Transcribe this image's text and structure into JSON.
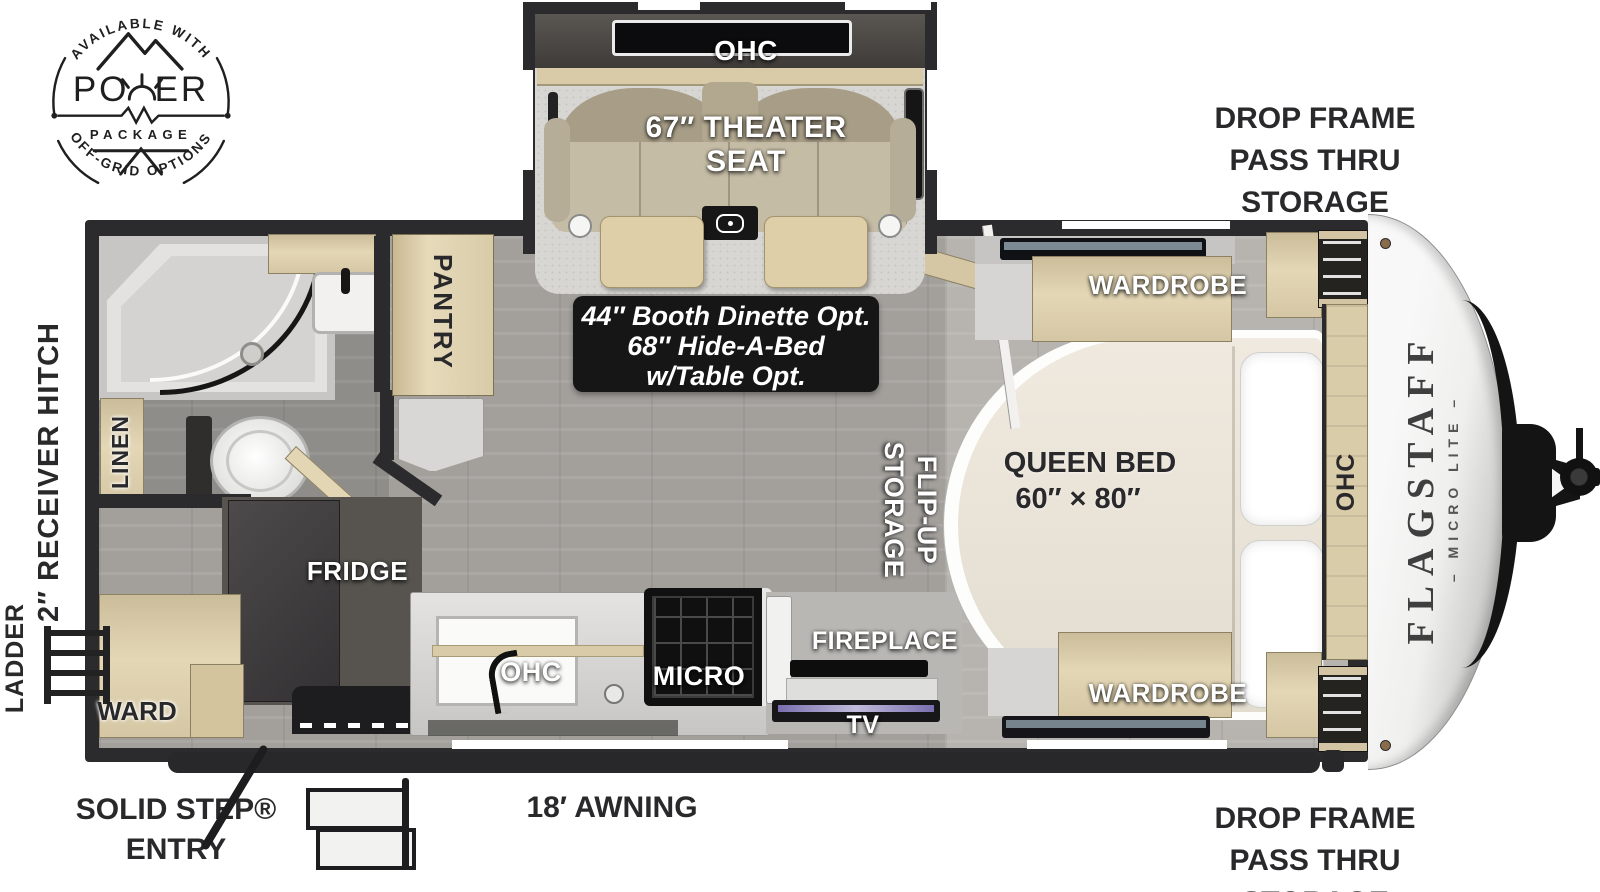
{
  "badge": {
    "arc_top": "AVAILABLE WITH",
    "power_left": "PO",
    "power_right": "ER",
    "package": "PACKAGE",
    "arc_bottom": "OFF-GRID OPTIONS"
  },
  "slide": {
    "ohc": "OHC",
    "seat_line1": "67″ THEATER",
    "seat_line2": "SEAT"
  },
  "storage_top": {
    "l1": "DROP FRAME",
    "l2": "PASS THRU",
    "l3": "STORAGE"
  },
  "storage_bottom": {
    "l1": "DROP FRAME",
    "l2": "PASS THRU",
    "l3": "STORAGE"
  },
  "bedroom": {
    "wardrobe_top": "WARDROBE",
    "wardrobe_bottom": "WARDROBE",
    "queen_line1": "QUEEN BED",
    "queen_line2": "60″ × 80″",
    "ohc": "OHC",
    "flip_line1": "FLIP-UP",
    "flip_line2": "STORAGE"
  },
  "brand": {
    "name": "FLAGSTAFF",
    "sub": "– MICRO LITE –"
  },
  "galley": {
    "pantry": "PANTRY",
    "fridge": "FRIDGE",
    "linen": "LINEN",
    "ward": "WARD",
    "ohc": "OHC",
    "micro": "MICRO",
    "fireplace": "FIREPLACE",
    "tv": "TV"
  },
  "option_box": {
    "l1": "44″ Booth Dinette Opt.",
    "l2": "68″ Hide-A-Bed",
    "l3": "w/Table Opt."
  },
  "exterior": {
    "receiver_hitch": "2″ RECEIVER HITCH",
    "ladder": "LADDER",
    "entry_line1": "SOLID STEP®",
    "entry_line2": "ENTRY",
    "awning": "18′ AWNING"
  },
  "colors": {
    "wall": "#2b2a2c",
    "wood": "#ddcfae",
    "floor": "#a3a09c",
    "bedroom_floor": "#b7b4af",
    "carpet": "#d7d6d2",
    "label_white": "#ffffff",
    "label_dark": "#29282a",
    "option_box_bg": "#161616"
  }
}
